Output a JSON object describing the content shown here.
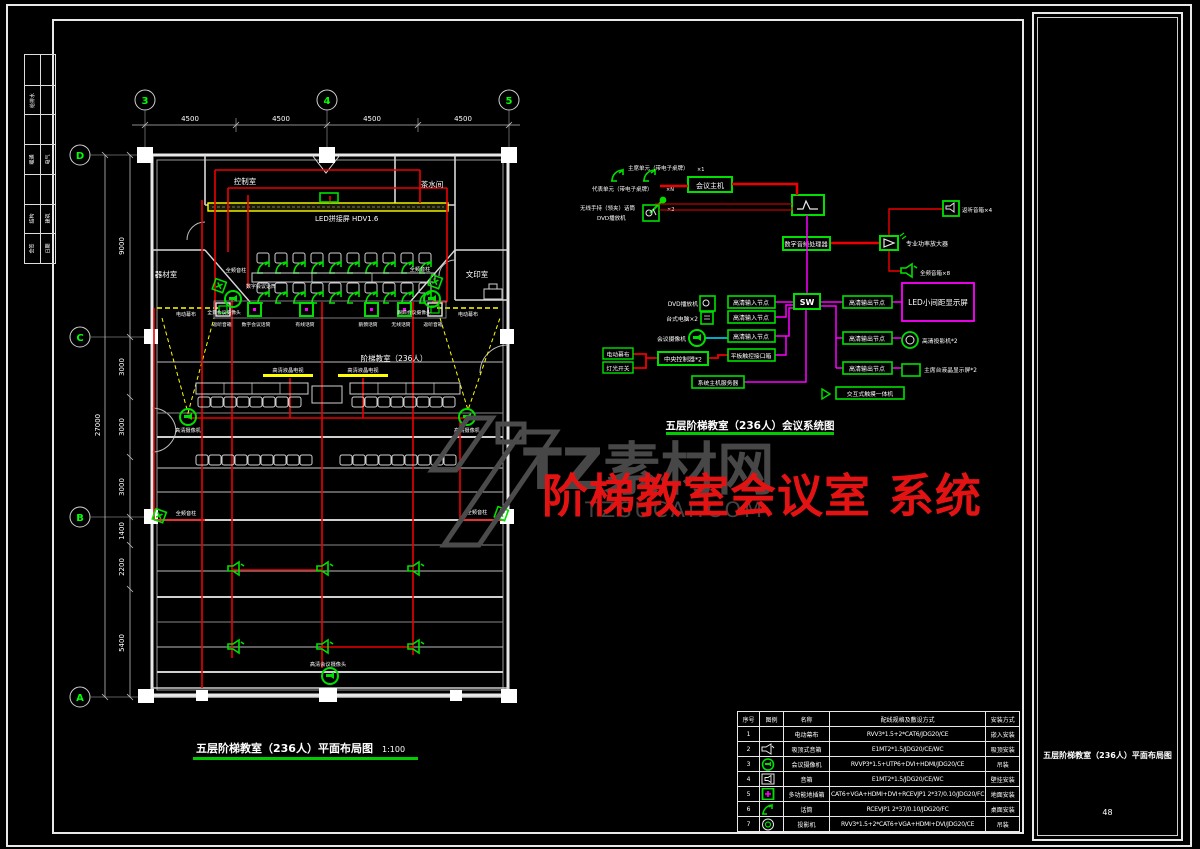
{
  "frame": {
    "page_no": "48",
    "panel_title": "五层阶梯教室（236人）平面布局图"
  },
  "sign_strip": {
    "r2l": "给排水",
    "r4l": "暖通",
    "r4r": "电气",
    "r6l": "结构",
    "r6r": "建筑",
    "r7l": "会签",
    "r7r": "日期"
  },
  "watermark": {
    "brand": "TZ素材网",
    "domain": "TZSUCAI.COM",
    "overlay": "阶梯教室会议室 系统",
    "brand_color": "#474747",
    "overlay_color": "#e41313"
  },
  "plan": {
    "title": "五层阶梯教室（236人）平面布局图",
    "scale": "1:100",
    "grid_cols": [
      "3",
      "4",
      "5"
    ],
    "grid_rows": [
      "D",
      "C",
      "B",
      "A"
    ],
    "top_dims": [
      "4500",
      "4500",
      "4500",
      "4500"
    ],
    "left_dims": [
      "9000",
      "3000",
      "3000",
      "3000",
      "1400",
      "2200",
      "5400"
    ],
    "total_dim": "27000",
    "room_control": "控制室",
    "room_tea": "茶水间",
    "room_equip": "器材室",
    "room_print": "文印室",
    "room_hall": "阶梯教室（236人）",
    "led": "LED拼接屏 HDV1.6",
    "curtain_left": "电动幕布",
    "curtain_right": "电动幕布",
    "col_speaker_tl": "全频音柱",
    "col_speaker_tr": "全频音柱",
    "col_speaker_bl": "全频音柱",
    "col_speaker_br": "全频音柱",
    "digital_mic": "数字会议话筒",
    "cam_podium_left": "全景会议摄像头",
    "cam_podium_right": "跟踪会议摄像头",
    "podium_labels": [
      "返听音箱",
      "数字会议话筒",
      "有线话筒",
      "鹅颈话筒",
      "无线话筒",
      "返听音箱"
    ],
    "tv_left": "高清液晶电视",
    "tv_right": "高清液晶电视",
    "cam_mid_left": "高清摄像机",
    "cam_mid_right": "高清摄像机",
    "cam_rear": "高清会议摄像头"
  },
  "system": {
    "title": "五层阶梯教室（236人）会议系统图",
    "chairman": "主席单元（带电子桌牌）",
    "chairman_qty": "×1",
    "delegate": "代表单元（带电子桌牌）",
    "delegate_qty": "×N",
    "wireless_mic": "无线手持（领夹）话筒",
    "wireless_qty": "×2",
    "dvd_a": "DVD播放机",
    "host": "会议主机",
    "processor": "数字音频处理器",
    "amp": "专业功率放大器",
    "monitor_speaker": "返听音箱×4",
    "main_speaker": "全频音箱×8",
    "led_screen": "LED小间距显示屏",
    "switch": "SW",
    "in_node_1": "高清输入节点",
    "in_node_2": "高清输入节点",
    "in_node_3": "高清输入节点",
    "out_node_1": "高清输出节点",
    "out_node_2": "高清输出节点",
    "out_node_3": "高清输出节点",
    "dvd_b": "DVD播放机",
    "pc": "台式电脑×2",
    "conf_camera": "会议摄像机",
    "curtain": "电动幕布",
    "lights": "灯光开关",
    "controller": "中央控制器*2",
    "panel_box": "平板触控接口箱",
    "server": "系统主机服务器",
    "projector": "高清投影机*2",
    "stage_lcd": "主席台液晶显示屏*2",
    "touch": "交互式触摸一体机"
  },
  "table": {
    "headers": [
      "序号",
      "图例",
      "名称",
      "配线规格及敷设方式",
      "安装方式"
    ],
    "rows": [
      {
        "no": "1",
        "name": "电动幕布",
        "spec": "RVV3*1.5+2*CAT6/JDG20/CE",
        "install": "嵌入安装"
      },
      {
        "no": "2",
        "name": "吸顶式音箱",
        "spec": "E1MT2*1.5/JDG20/CE/WC",
        "install": "吸顶安装"
      },
      {
        "no": "3",
        "name": "会议摄像机",
        "spec": "RVVP3*1.5+UTP6+DVI+HDMI/JDG20/CE",
        "install": "吊装"
      },
      {
        "no": "4",
        "name": "音箱",
        "spec": "E1MT2*1.5/JDG20/CE/WC",
        "install": "壁挂安装"
      },
      {
        "no": "5",
        "name": "多功能地插箱",
        "spec": "CAT6+VGA+HDMI+DVI+RCEVJP1 2*37/0.10/JDG20/FC",
        "install": "地面安装"
      },
      {
        "no": "6",
        "name": "话筒",
        "spec": "RCEVJP1 2*37/0.10/JDG20/FC",
        "install": "桌面安装"
      },
      {
        "no": "7",
        "name": "投影机",
        "spec": "RVV3*1.5+2*CAT6+VGA+HDMI+DVI/JDG20/CE",
        "install": "吊装"
      }
    ]
  }
}
